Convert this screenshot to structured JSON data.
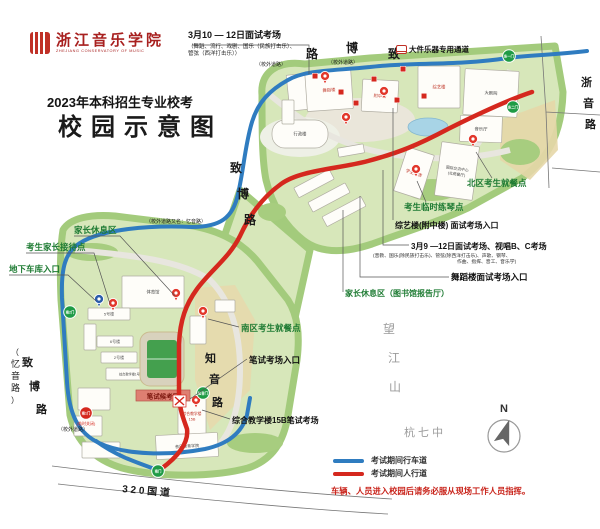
{
  "header": {
    "logo_cn": "浙江音乐学院",
    "logo_en": "ZHEJIANG CONSERVATORY OF MUSIC",
    "title_line1": "2023年本科招生专业校考",
    "title_line2": "校园示意图",
    "exam_note_title": "3月10 — 12日面试考场",
    "exam_note_detail1": "（舞蹈、流行、戏剧、国乐（民族打击乐）、",
    "exam_note_detail2": "管弦（西洋打击乐））",
    "channel_label": "大件乐器专用通道"
  },
  "legend": {
    "vehicle_label": "考试期间行车道",
    "pedestrian_label": "考试期间人行道",
    "warning": "车辆、人员进入校园后请务必服从现场工作人员指挥。",
    "north": "N",
    "vehicle_color": "#2f7cc0",
    "pedestrian_color": "#d5281e"
  },
  "colors": {
    "route_vehicle": "#2f7cc0",
    "route_pedestrian": "#d5281e",
    "callout_green": "#1e7b33",
    "gate_green": "#1f9b45",
    "gate_red": "#d5281e"
  },
  "map": {
    "banner": "笔试候考区",
    "buildings": [
      {
        "x": 288,
        "y": 74,
        "w": 24,
        "h": 36,
        "r": -6,
        "l": ""
      },
      {
        "x": 306,
        "y": 70,
        "w": 46,
        "h": 40,
        "r": -4,
        "l": "舞蹈楼",
        "c": "#c0392b"
      },
      {
        "x": 362,
        "y": 80,
        "w": 36,
        "h": 32,
        "r": 3,
        "l": "附中楼",
        "c": "#c0392b"
      },
      {
        "x": 418,
        "y": 66,
        "w": 42,
        "h": 42,
        "r": 0,
        "l": "综艺楼",
        "c": "#c0392b"
      },
      {
        "x": 464,
        "y": 70,
        "w": 54,
        "h": 46,
        "r": 3,
        "l": "大剧院",
        "c": "#444"
      },
      {
        "x": 460,
        "y": 116,
        "w": 42,
        "h": 26,
        "r": 2,
        "l": "音乐厅",
        "c": "#444"
      },
      {
        "x": 272,
        "y": 120,
        "w": 56,
        "h": 28,
        "r": 0,
        "rx": 13,
        "l": "行政楼",
        "c": "#444"
      },
      {
        "x": 438,
        "y": 144,
        "w": 38,
        "h": 54,
        "r": 8,
        "l": "国际交流中心",
        "l2": "(北苑餐厅)",
        "c": "#444",
        "fs": 3.8
      },
      {
        "x": 400,
        "y": 150,
        "w": 28,
        "h": 46,
        "r": 18,
        "l": "学生宿舍",
        "c": "#c0392b"
      },
      {
        "x": 282,
        "y": 100,
        "w": 12,
        "h": 24,
        "r": 0,
        "l": ""
      },
      {
        "x": 294,
        "y": 178,
        "w": 40,
        "h": 11,
        "r": -28,
        "l": ""
      },
      {
        "x": 308,
        "y": 192,
        "w": 42,
        "h": 11,
        "r": -28,
        "l": ""
      },
      {
        "x": 322,
        "y": 206,
        "w": 44,
        "h": 11,
        "r": -28,
        "l": ""
      },
      {
        "x": 338,
        "y": 146,
        "w": 26,
        "h": 9,
        "r": -10,
        "l": ""
      },
      {
        "x": 122,
        "y": 276,
        "w": 62,
        "h": 32,
        "r": 0,
        "l": "体育馆",
        "c": "#444"
      },
      {
        "x": 88,
        "y": 308,
        "w": 42,
        "h": 12,
        "r": 0,
        "l": "5号楼",
        "c": "#555",
        "fs": 4
      },
      {
        "x": 84,
        "y": 324,
        "w": 12,
        "h": 26,
        "r": 0,
        "l": ""
      },
      {
        "x": 97,
        "y": 336,
        "w": 36,
        "h": 11,
        "r": 0,
        "l": "6号楼",
        "c": "#555",
        "fs": 4
      },
      {
        "x": 101,
        "y": 352,
        "w": 36,
        "h": 11,
        "r": 0,
        "l": "2号楼",
        "c": "#555",
        "fs": 4
      },
      {
        "x": 106,
        "y": 368,
        "w": 50,
        "h": 12,
        "r": 0,
        "l": "综合教学楼1号楼",
        "c": "#555",
        "fs": 3.2
      },
      {
        "x": 78,
        "y": 388,
        "w": 32,
        "h": 22,
        "r": 0,
        "l": ""
      },
      {
        "x": 74,
        "y": 416,
        "w": 28,
        "h": 20,
        "r": 0,
        "l": ""
      },
      {
        "x": 82,
        "y": 442,
        "w": 38,
        "h": 16,
        "r": 0,
        "l": ""
      },
      {
        "x": 178,
        "y": 398,
        "w": 28,
        "h": 36,
        "r": 0,
        "l": "综合教学楼",
        "l2": "15B",
        "c": "#c0392b",
        "fs": 3.8
      },
      {
        "x": 156,
        "y": 434,
        "w": 62,
        "h": 24,
        "r": -3,
        "l": "音乐教育学院",
        "c": "#444",
        "fs": 4
      },
      {
        "x": 190,
        "y": 316,
        "w": 16,
        "h": 28,
        "r": 0,
        "l": ""
      },
      {
        "x": 215,
        "y": 300,
        "w": 20,
        "h": 12,
        "r": 0,
        "l": ""
      }
    ],
    "gates": [
      {
        "x": 509,
        "y": 56,
        "t": "东一门",
        "c": "#1f9b45"
      },
      {
        "x": 513,
        "y": 107,
        "t": "东二门",
        "c": "#1f9b45"
      },
      {
        "x": 70,
        "y": 312,
        "t": "南2门",
        "c": "#1f9b45"
      },
      {
        "x": 86,
        "y": 413,
        "t": "南1门",
        "c": "#d5281e",
        "sub": "(临时关闭)"
      },
      {
        "x": 203,
        "y": 393,
        "t": "知音门",
        "c": "#1f9b45"
      },
      {
        "x": 158,
        "y": 471,
        "t": "南门",
        "c": "#1f9b45"
      }
    ],
    "pins": [
      {
        "x": 325,
        "y": 83,
        "k": "red"
      },
      {
        "x": 384,
        "y": 98,
        "k": "red"
      },
      {
        "x": 346,
        "y": 124,
        "k": "red"
      },
      {
        "x": 473,
        "y": 146,
        "k": "red"
      },
      {
        "x": 416,
        "y": 176,
        "k": "red"
      },
      {
        "x": 176,
        "y": 300,
        "k": "red"
      },
      {
        "x": 113,
        "y": 310,
        "k": "red"
      },
      {
        "x": 203,
        "y": 318,
        "k": "red"
      },
      {
        "x": 196,
        "y": 407,
        "k": "red"
      },
      {
        "x": 99,
        "y": 306,
        "k": "blue"
      }
    ],
    "squares": [
      [
        315,
        76
      ],
      [
        341,
        92
      ],
      [
        356,
        103
      ],
      [
        374,
        79
      ],
      [
        397,
        100
      ],
      [
        424,
        96
      ],
      [
        403,
        69
      ]
    ],
    "labels": [
      {
        "t": "路",
        "x": 306,
        "y": 58,
        "s": 12,
        "b": 1
      },
      {
        "t": "博",
        "x": 346,
        "y": 52,
        "s": 12,
        "b": 1
      },
      {
        "t": "致",
        "x": 388,
        "y": 58,
        "s": 12,
        "b": 1
      },
      {
        "t": "（校外道路）",
        "x": 256,
        "y": 66,
        "s": 5
      },
      {
        "t": "（校外道路）",
        "x": 328,
        "y": 64,
        "s": 5
      },
      {
        "t": "致",
        "x": 230,
        "y": 172,
        "s": 12,
        "b": 1
      },
      {
        "t": "博",
        "x": 237,
        "y": 198,
        "s": 12,
        "b": 1
      },
      {
        "t": "路",
        "x": 244,
        "y": 224,
        "s": 12,
        "b": 1
      },
      {
        "t": "（校外道路又名：忆音路）",
        "x": 146,
        "y": 223,
        "s": 5
      },
      {
        "t": "知",
        "x": 205,
        "y": 362,
        "s": 11,
        "b": 1
      },
      {
        "t": "音",
        "x": 209,
        "y": 383,
        "s": 11,
        "b": 1
      },
      {
        "t": "路",
        "x": 212,
        "y": 406,
        "s": 11,
        "b": 1
      },
      {
        "t": "浙",
        "x": 581,
        "y": 86,
        "s": 11,
        "b": 1
      },
      {
        "t": "音",
        "x": 583,
        "y": 107,
        "s": 11,
        "b": 1
      },
      {
        "t": "路",
        "x": 585,
        "y": 128,
        "s": 11,
        "b": 1
      },
      {
        "t": "望",
        "x": 383,
        "y": 333,
        "s": 12,
        "c": "#9b9b9b"
      },
      {
        "t": "江",
        "x": 388,
        "y": 362,
        "s": 12,
        "c": "#9b9b9b"
      },
      {
        "t": "山",
        "x": 389,
        "y": 391,
        "s": 12,
        "c": "#9b9b9b"
      },
      {
        "t": "杭 七 中",
        "x": 404,
        "y": 436,
        "s": 11,
        "c": "#9b9b9b"
      },
      {
        "t": "3 2 0  国  道",
        "x": 122,
        "y": 492,
        "s": 10,
        "b": 1,
        "r": 5
      },
      {
        "t": "（",
        "x": 11,
        "y": 355,
        "s": 8
      },
      {
        "t": "忆",
        "x": 11,
        "y": 367,
        "s": 9
      },
      {
        "t": "音",
        "x": 11,
        "y": 379,
        "s": 9
      },
      {
        "t": "路",
        "x": 11,
        "y": 391,
        "s": 9
      },
      {
        "t": "）",
        "x": 11,
        "y": 403,
        "s": 8
      },
      {
        "t": "致",
        "x": 22,
        "y": 366,
        "s": 11,
        "b": 1
      },
      {
        "t": "博",
        "x": 29,
        "y": 390,
        "s": 11,
        "b": 1
      },
      {
        "t": "路",
        "x": 36,
        "y": 413,
        "s": 11,
        "b": 1
      },
      {
        "t": "（校外道路）",
        "x": 58,
        "y": 431,
        "s": 5
      }
    ],
    "callouts": [
      {
        "t": "家长休息区",
        "x": 74,
        "y": 233,
        "s": 8.5,
        "c": "#1e7b33",
        "b": 1,
        "line": [
          [
            74,
            236
          ],
          [
            120,
            236
          ],
          [
            175,
            296
          ]
        ]
      },
      {
        "t": "考生家长接待点",
        "x": 26,
        "y": 250,
        "s": 8.5,
        "c": "#1e7b33",
        "b": 1,
        "line": [
          [
            26,
            253
          ],
          [
            94,
            253
          ],
          [
            110,
            304
          ]
        ]
      },
      {
        "t": "地下车库入口",
        "x": 9,
        "y": 272,
        "s": 8.5,
        "c": "#1e7b33",
        "b": 1,
        "line": [
          [
            9,
            275
          ],
          [
            68,
            275
          ],
          [
            96,
            301
          ]
        ]
      },
      {
        "t": "北区考生就餐点",
        "x": 467,
        "y": 186,
        "s": 8.5,
        "c": "#1e7b33",
        "b": 1,
        "line": [
          [
            492,
            178
          ],
          [
            476,
            152
          ]
        ]
      },
      {
        "t": "考生临时练琴点",
        "x": 404,
        "y": 210,
        "s": 8.5,
        "c": "#1e7b33",
        "b": 1,
        "line": [
          [
            426,
            202
          ],
          [
            417,
            181
          ]
        ]
      },
      {
        "t": "综艺楼(附中楼) 面试考场入口",
        "x": 395,
        "y": 228,
        "s": 8,
        "c": "#111",
        "b": 1,
        "line": [
          [
            393,
            220
          ],
          [
            393,
            108
          ]
        ]
      },
      {
        "t": "3月9 —12日面试考场、视唱B、C考场",
        "x": 411,
        "y": 249,
        "s": 8,
        "c": "#111",
        "b": 1,
        "line": [
          [
            409,
            245
          ],
          [
            383,
            245
          ],
          [
            383,
            170
          ]
        ]
      },
      {
        "t": "(音教、国乐(除民族打击乐)、管弦(除西洋打击乐)、声歌、钢琴、",
        "x": 373,
        "y": 257,
        "s": 4.8,
        "c": "#333"
      },
      {
        "t": "作曲、指挥、音工、音乐学)",
        "x": 457,
        "y": 263,
        "s": 4.8,
        "c": "#333"
      },
      {
        "t": "舞蹈楼面试考场入口",
        "x": 451,
        "y": 280,
        "s": 8.5,
        "c": "#111",
        "b": 1,
        "line": [
          [
            449,
            277
          ],
          [
            360,
            277
          ],
          [
            360,
            196
          ]
        ]
      },
      {
        "t": "家长休息区（图书馆报告厅）",
        "x": 345,
        "y": 296,
        "s": 8,
        "c": "#1e7b33",
        "b": 1,
        "line": [
          [
            343,
            292
          ],
          [
            343,
            210
          ]
        ]
      },
      {
        "t": "南区考生就餐点",
        "x": 241,
        "y": 331,
        "s": 8.5,
        "c": "#1e7b33",
        "b": 1,
        "line": [
          [
            239,
            327
          ],
          [
            208,
            319
          ]
        ]
      },
      {
        "t": "笔试考场入口",
        "x": 249,
        "y": 363,
        "s": 8.5,
        "c": "#111",
        "b": 1,
        "line": [
          [
            247,
            359
          ],
          [
            190,
            399
          ]
        ]
      },
      {
        "t": "综合教学楼15B笔试考场",
        "x": 232,
        "y": 423,
        "s": 8,
        "c": "#111",
        "b": 1,
        "line": [
          [
            230,
            419
          ],
          [
            202,
            410
          ]
        ]
      }
    ],
    "extra_lines": [
      [
        [
          192,
          45
        ],
        [
          309,
          45
        ],
        [
          309,
          74
        ]
      ]
    ]
  }
}
